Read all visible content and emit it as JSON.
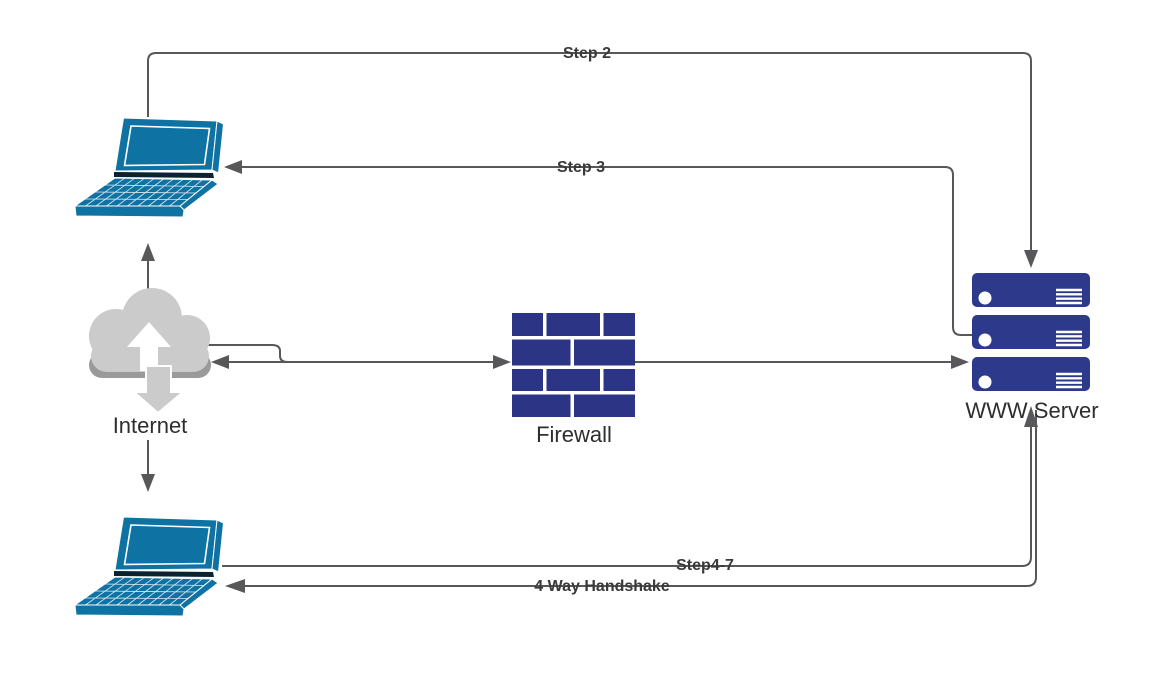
{
  "canvas": {
    "width": 1163,
    "height": 695,
    "background": "#FFFFFF"
  },
  "colors": {
    "laptop": "#0E72A2",
    "laptop_dark": "#0B2330",
    "cloud": "#CBCBCB",
    "cloud_rim": "#9A9A9A",
    "firewall": "#2B3485",
    "server": "#2D3A8C",
    "line": "#58585A",
    "edge_label": "#3A3A3A",
    "node_label": "#2E2E2E"
  },
  "nodes": {
    "client_top": {
      "type": "laptop",
      "label": ""
    },
    "internet": {
      "type": "cloud",
      "label": "Internet"
    },
    "firewall": {
      "type": "brick-wall",
      "label": "Firewall"
    },
    "server": {
      "type": "server-stack",
      "label": "WWW Server"
    },
    "client_bottom": {
      "type": "laptop",
      "label": ""
    }
  },
  "edges": {
    "step2": {
      "label": "Step 2",
      "from": "client_top",
      "to": "server"
    },
    "step3": {
      "label": "Step 3",
      "from": "server",
      "to": "client_top"
    },
    "internet_to_client_top": {
      "from": "internet",
      "to": "client_top"
    },
    "internet_to_client_bottom": {
      "from": "internet",
      "to": "client_bottom"
    },
    "internet_firewall": {
      "from": "internet",
      "to": "firewall",
      "bidirectional": true
    },
    "firewall_to_server": {
      "from": "firewall",
      "to": "server"
    },
    "step47": {
      "label": "Step4-7",
      "from": "client_bottom",
      "to": "server"
    },
    "handshake": {
      "label": "4 Way Handshake",
      "from": "server",
      "to": "client_bottom"
    }
  }
}
